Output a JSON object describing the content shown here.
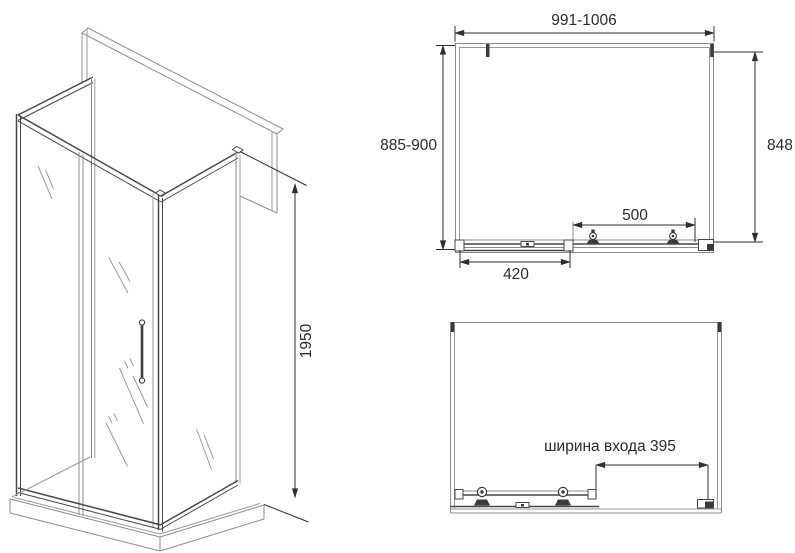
{
  "drawing": {
    "title": "shower-enclosure-technical-drawing",
    "background": "#ffffff",
    "line_color": "#8c8c8c",
    "frame_color": "#474747",
    "dimension_color": "#2f2f2f",
    "text_color": "#2b2b2b"
  },
  "isometric_view": {
    "description": "corner shower enclosure with sliding door, side panels and tray",
    "height_mm": "1950"
  },
  "top_plan_view": {
    "width_range_mm": "991-1006",
    "depth_range_mm": "885-900",
    "side_panel_mm": "848",
    "door_opening_mm": "500",
    "fixed_segment_mm": "420"
  },
  "bottom_plan_view": {
    "entry_width_label": "ширина входа 395"
  }
}
